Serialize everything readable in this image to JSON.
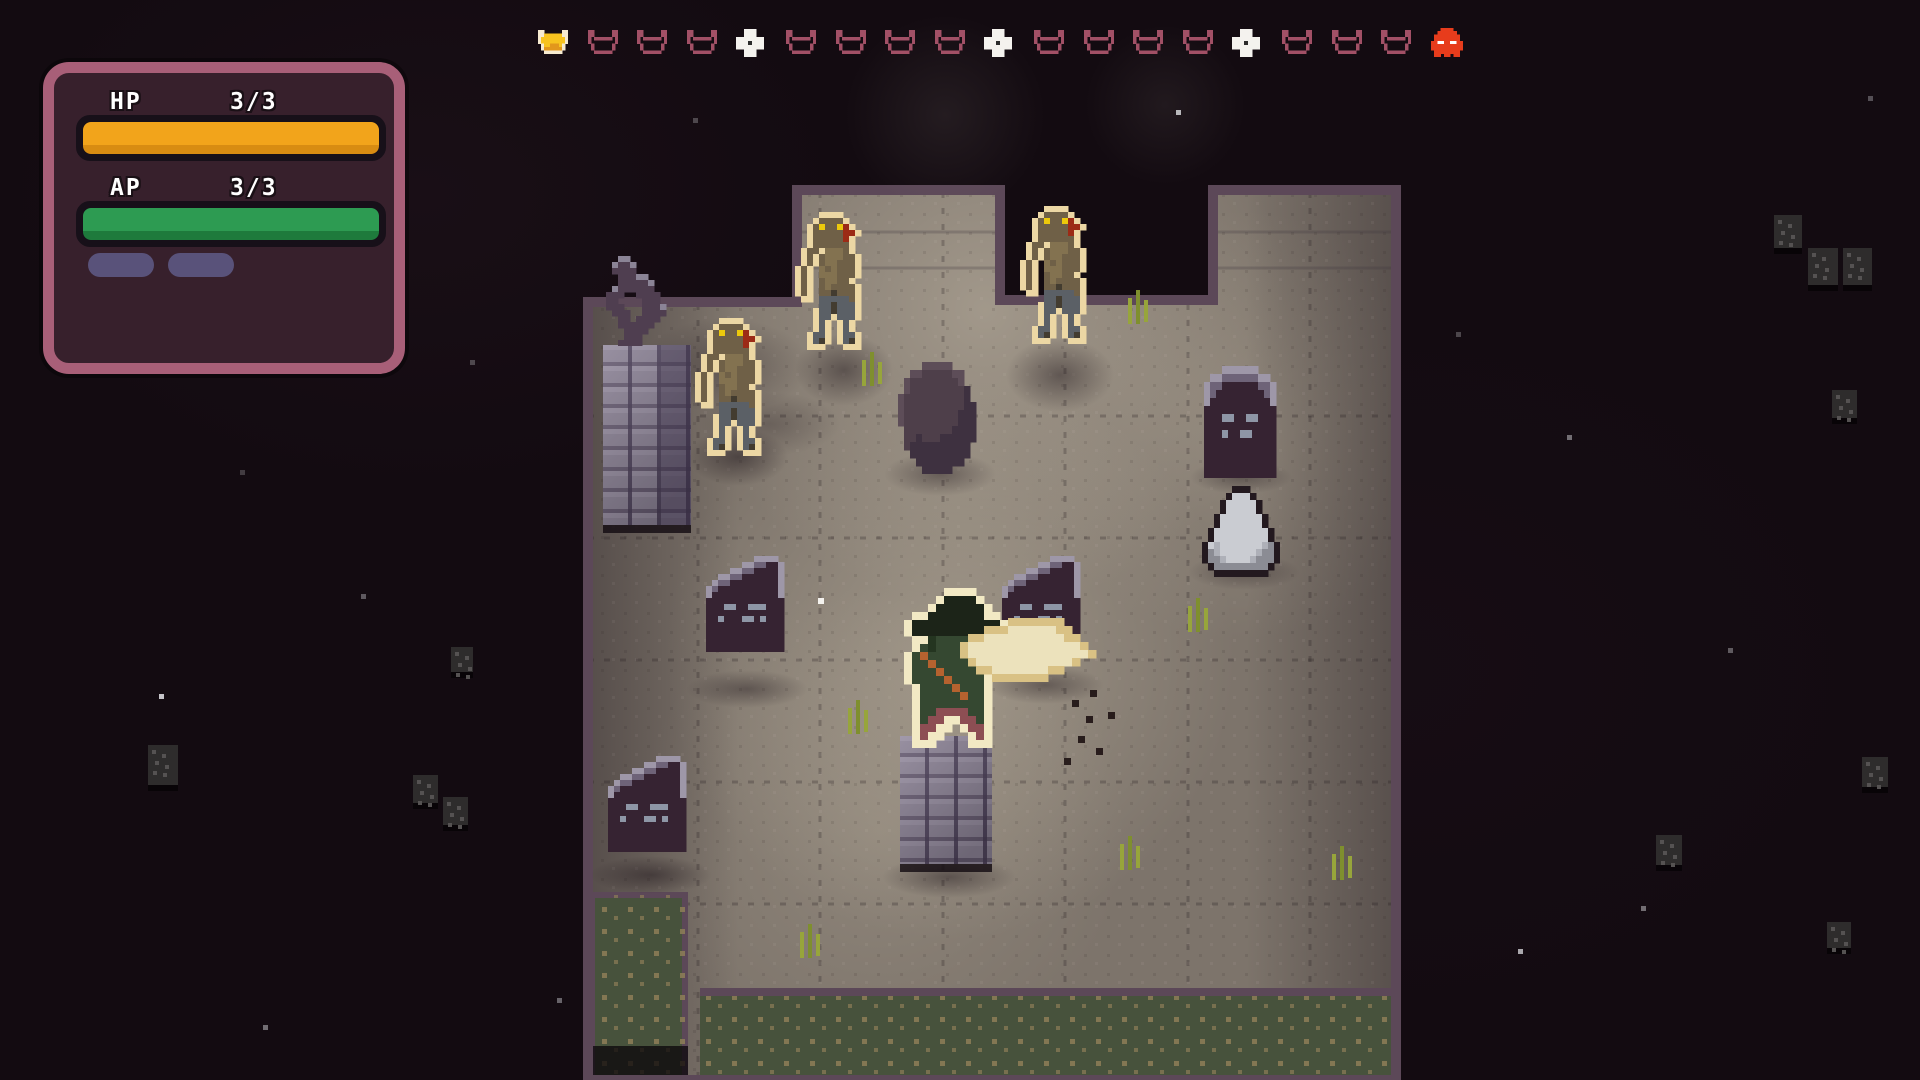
{
  "hud": {
    "hp_label": "HP",
    "hp_value": "3/3",
    "ap_label": "AP",
    "ap_value": "3/3",
    "skill_slot_count": 2,
    "colors": {
      "hp_bar": "#f2a41b",
      "hp_bar_shade": "#d88c12",
      "ap_bar": "#2d9b52",
      "ap_bar_shade": "#1e7a3c",
      "panel_border": "#a85f78",
      "panel_bg": "#37202c",
      "bar_border": "#171019",
      "slot_pill": "#59527a"
    }
  },
  "turn_tracker": {
    "start_x": 538,
    "y": 30,
    "spacing": 49.6,
    "icons": [
      "player-turn-filled",
      "turn",
      "turn",
      "turn",
      "special-turn",
      "turn",
      "turn",
      "turn",
      "turn",
      "special-turn",
      "turn",
      "turn",
      "turn",
      "turn",
      "special-turn",
      "turn",
      "turn",
      "turn",
      "enemy-turn"
    ],
    "colors": {
      "turn_outline": "#a25066",
      "player_fill": "#f7c31f",
      "player_fill_shade": "#e2971c",
      "player_outline": "#f6ead0",
      "special": "#f4f2ee",
      "enemy": "#e73c1c"
    }
  },
  "scene": {
    "background": "#130b11",
    "ground": {
      "base": "#7d746b",
      "border": "#5c4858",
      "grass": "#47523c",
      "grass_speck": "#8d7e57"
    },
    "entities": [
      {
        "name": "statue-pedestal",
        "type": "brick",
        "cls": "pedestal",
        "x": 603,
        "y": 345,
        "w": 88,
        "h": 180
      },
      {
        "name": "statue",
        "sprite": "statue",
        "x": 600,
        "y": 256
      },
      {
        "name": "gravestone-right",
        "sprite": "grave_round",
        "x": 1198,
        "y": 366
      },
      {
        "name": "white-rock",
        "sprite": "rock",
        "x": 1202,
        "y": 486
      },
      {
        "name": "boulder",
        "sprite": "boulder",
        "x": 898,
        "y": 362
      },
      {
        "name": "gravestone-mid-left",
        "sprite": "grave",
        "x": 700,
        "y": 556
      },
      {
        "name": "gravestone-center",
        "sprite": "grave",
        "x": 996,
        "y": 556
      },
      {
        "name": "gravestone-bottom-left",
        "sprite": "grave",
        "x": 602,
        "y": 756
      },
      {
        "name": "player-pillar",
        "type": "brick",
        "cls": "",
        "x": 900,
        "y": 736,
        "w": 92,
        "h": 128
      },
      {
        "name": "zombie-left",
        "sprite": "zombie",
        "x": 695,
        "y": 318
      },
      {
        "name": "zombie-top-left",
        "sprite": "zombie",
        "x": 795,
        "y": 212
      },
      {
        "name": "zombie-top-right",
        "sprite": "zombie",
        "x": 1020,
        "y": 206
      },
      {
        "name": "player-character",
        "sprite": "player",
        "x": 888,
        "y": 588
      },
      {
        "name": "sword-slash",
        "sprite": "sword",
        "x": 944,
        "y": 618
      }
    ],
    "shadows": [
      [
        640,
        318,
        170,
        95,
        0.3
      ],
      [
        700,
        392,
        140,
        64,
        0.25
      ],
      [
        688,
        428,
        100,
        58,
        0.5
      ],
      [
        795,
        334,
        98,
        72,
        0.45
      ],
      [
        1006,
        338,
        108,
        74,
        0.45
      ],
      [
        884,
        452,
        112,
        44,
        0.4
      ],
      [
        1190,
        460,
        102,
        34,
        0.4
      ],
      [
        1188,
        554,
        112,
        36,
        0.35
      ],
      [
        686,
        670,
        122,
        38,
        0.4
      ],
      [
        986,
        666,
        118,
        38,
        0.4
      ],
      [
        590,
        856,
        122,
        38,
        0.45
      ],
      [
        882,
        856,
        134,
        42,
        0.45
      ]
    ],
    "stars": [
      [
        1176,
        110,
        0.9
      ],
      [
        159,
        694,
        0.95
      ],
      [
        361,
        594,
        0.4
      ],
      [
        1567,
        435,
        0.5
      ],
      [
        1641,
        906,
        0.5
      ],
      [
        1518,
        949,
        0.8
      ],
      [
        557,
        998,
        0.45
      ],
      [
        263,
        1025,
        0.5
      ],
      [
        693,
        118,
        0.3
      ],
      [
        1868,
        96,
        0.35
      ],
      [
        470,
        360,
        0.3
      ],
      [
        1728,
        648,
        0.4
      ],
      [
        1456,
        332,
        0.3
      ],
      [
        240,
        470,
        0.25
      ]
    ],
    "blocks": [
      [
        1774,
        215,
        28,
        33
      ],
      [
        1808,
        248,
        30,
        37
      ],
      [
        1843,
        248,
        29,
        37
      ],
      [
        148,
        745,
        30,
        40
      ],
      [
        413,
        775,
        25,
        28
      ],
      [
        443,
        797,
        25,
        28
      ],
      [
        451,
        647,
        22,
        25
      ],
      [
        1832,
        390,
        25,
        28
      ],
      [
        1862,
        757,
        26,
        30
      ],
      [
        1656,
        835,
        26,
        30
      ],
      [
        1827,
        922,
        24,
        26
      ]
    ],
    "tufts": [
      [
        862,
        352
      ],
      [
        1128,
        290
      ],
      [
        848,
        700
      ],
      [
        1120,
        836
      ],
      [
        1188,
        598
      ],
      [
        800,
        924
      ],
      [
        1332,
        846
      ]
    ],
    "splatter": [
      [
        1072,
        700
      ],
      [
        1086,
        716
      ],
      [
        1078,
        736
      ],
      [
        1096,
        748
      ],
      [
        1108,
        712
      ],
      [
        1064,
        758
      ],
      [
        1090,
        690
      ]
    ],
    "sparkles": [
      [
        818,
        598
      ]
    ]
  }
}
